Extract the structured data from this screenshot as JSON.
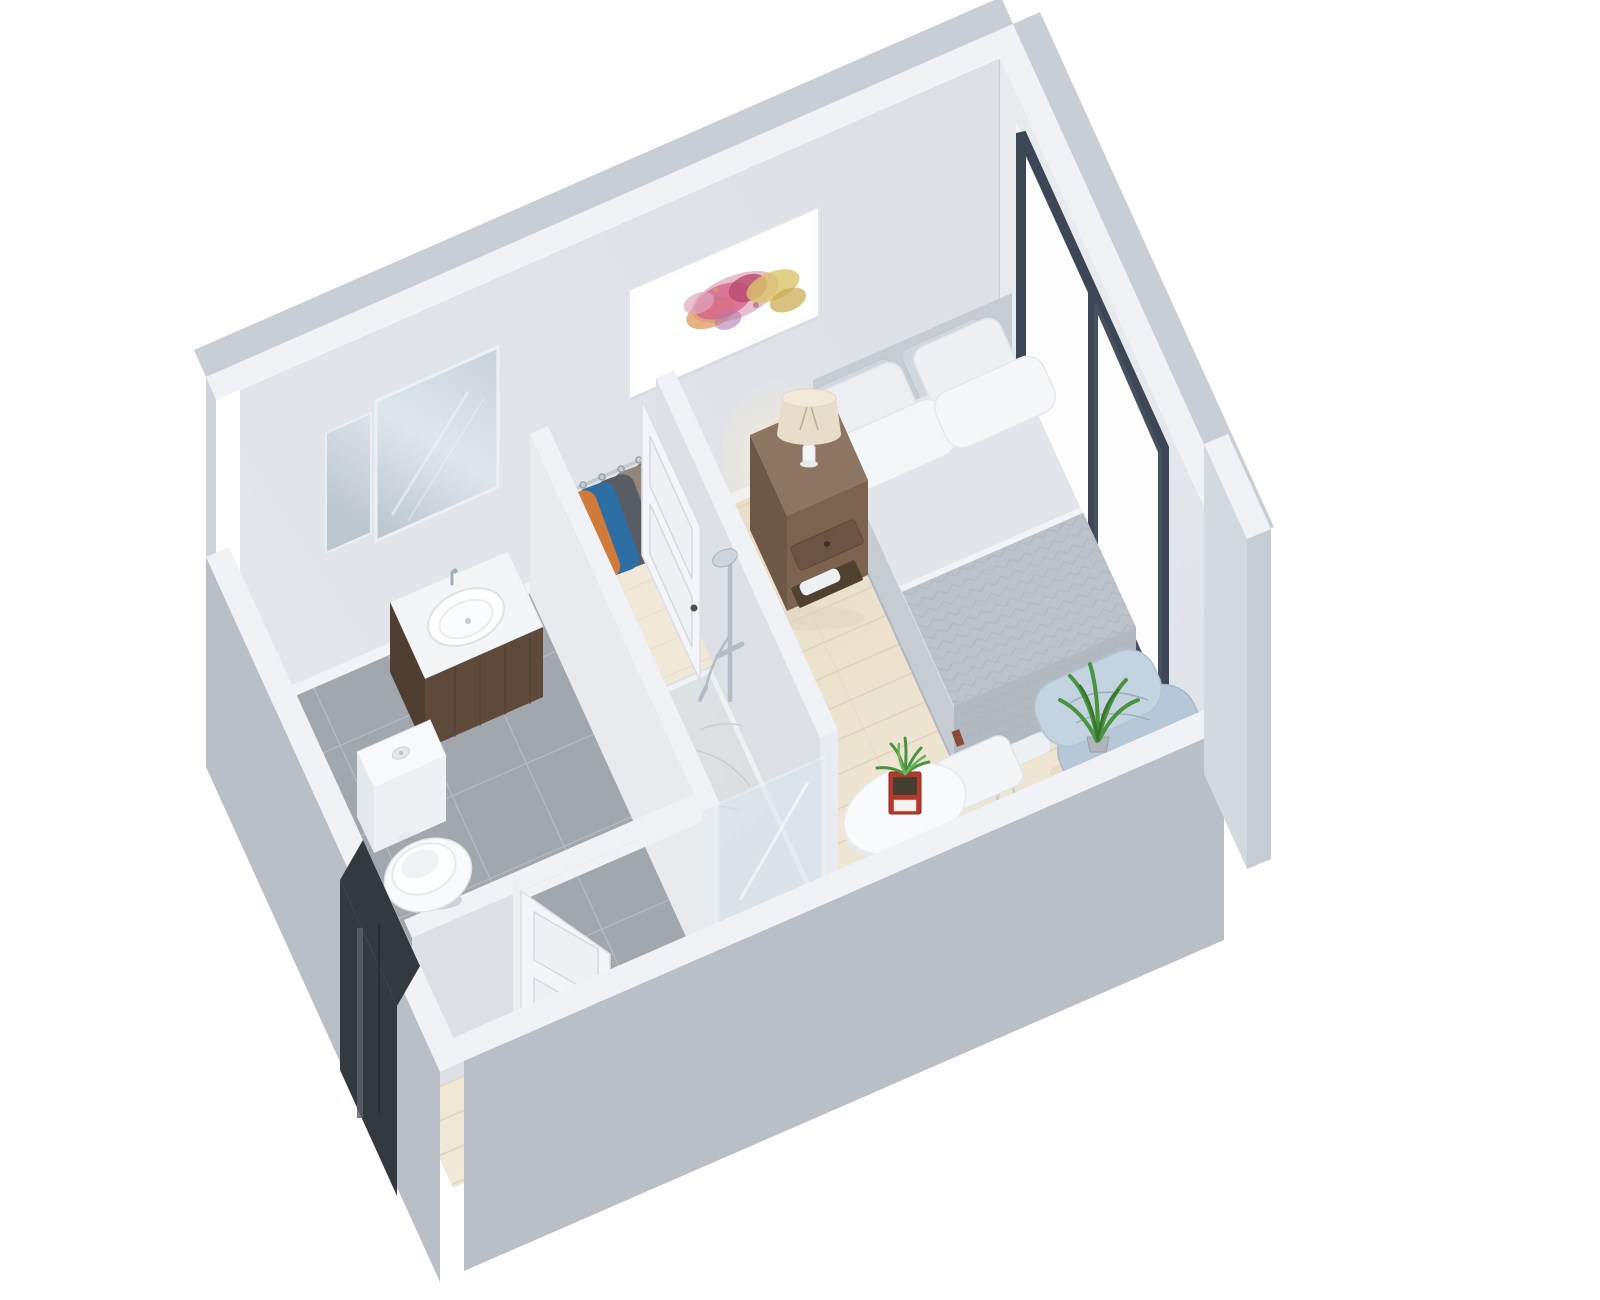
{
  "meta": {
    "title": "3D isometric floor plan render of a studio apartment with bathroom, shower, closet, bedroom and dining corner",
    "view": "dollhouse cutaway, back walls full height, front walls cut low",
    "canvas": {
      "width": 1600,
      "height": 1300
    }
  },
  "palette": {
    "background": "#ffffff",
    "wall_top": "#f0f2f6",
    "wall_exterior": "#c9ced6",
    "wall_exterior_dark": "#b9bec7",
    "wall_interior": "#dde0e5",
    "wall_interior_bright": "#e8eaee",
    "baseboard": "#f1f3f6",
    "wood_floor": "#e7dbc4",
    "wood_floor_light": "#f3ecdd",
    "plank_line": "#ddd1ba",
    "closet_floor": "#f0e9da",
    "tile_floor": "#a2a7ad",
    "tile_grout": "#b8bdc3",
    "marble_floor": "#d9dcdf",
    "marble_vein": "#c6cbd0",
    "shower_glass": "#dce9f1",
    "window_frame": "#3d4654",
    "door_white": "#f3f5f8",
    "door_panel_line": "#d5d9df",
    "door_handle": "#4a4e55",
    "entry_glass": "#34383f",
    "headboard": "#c7ccd3",
    "mattress_top": "#dadde2",
    "bed_sheet": "#e2e5e9",
    "mattress_side": "#c7ccd3",
    "mattress_foot": "#bfc5cc",
    "blanket": "#bdc2ca",
    "blanket_drape": "#b3b9c1",
    "chevron_line": "#a9afba",
    "pillow_white": "#f5f6f8",
    "nightstand_top": "#8d7563",
    "nightstand_front": "#7b634f",
    "nightstand_side": "#6d5847",
    "lamp_shade": "#e7ddca",
    "lamp_glow": "#f6ecd9",
    "art_pink_light": "#e0a7bc",
    "art_magenta": "#d4648c",
    "art_crimson": "#b84a6e",
    "art_orange": "#dd9a5e",
    "art_yellow": "#d9c469",
    "art_gold": "#c9a84c",
    "art_lilac": "#b07ab0",
    "lounge_blue_back": "#b6c8d7",
    "lounge_blue_seat": "#c4d3e0",
    "plant_green": "#4a9340",
    "plant_green_light": "#6fb35a",
    "planter_red": "#b5382d",
    "table_white": "#f8fafb",
    "chair_white": "#f3f5f7",
    "chair_leg": "#c9ced4",
    "chrome": "#b4bdc6",
    "toilet_white": "#f8fafb",
    "vanity_wood": "#5d4a3b",
    "vanity_wood_dark": "#4f3f33",
    "counter_white": "#f3f5f7",
    "jacket_colors": [
      "#d07b3c",
      "#2e6fa3",
      "#585c63",
      "#93867a",
      "#6f6961",
      "#4f5257"
    ],
    "shadow_wood": "#ddd3bf"
  },
  "scene": {
    "rooms": [
      {
        "id": "bedroom",
        "label": "Bedroom and living area, light wood floor"
      },
      {
        "id": "bathroom",
        "label": "Bathroom, gray tile floor"
      },
      {
        "id": "shower",
        "label": "Walk-in shower, marble floor, glass front"
      },
      {
        "id": "closet",
        "label": "Open closet with hanging clothes"
      },
      {
        "id": "entry",
        "label": "Entry hall with dark glass entry door"
      }
    ],
    "furniture": [
      {
        "id": "bed",
        "label": "Double bed with gray headboard, white pillows and herringbone blanket"
      },
      {
        "id": "wall-art",
        "label": "Framed abstract watercolor artwork in pink, orange and yellow"
      },
      {
        "id": "nightstand",
        "label": "Wooden nightstand with drawer, shelf and towel"
      },
      {
        "id": "table-lamp",
        "label": "Table lamp with warm glow"
      },
      {
        "id": "window",
        "label": "Large sliding window with dark frame"
      },
      {
        "id": "lounge-chair",
        "label": "Light blue butterfly lounge chair"
      },
      {
        "id": "floor-plant",
        "label": "Green floor plant"
      },
      {
        "id": "dining-table",
        "label": "Round white dining table with red planter box"
      },
      {
        "id": "dining-chair-a",
        "label": "White dining chair, upper"
      },
      {
        "id": "dining-chair-b",
        "label": "White dining chair, lower"
      },
      {
        "id": "toilet",
        "label": "White toilet"
      },
      {
        "id": "vanity",
        "label": "Dark wood vanity with white sink and mirror"
      },
      {
        "id": "shower-set",
        "label": "Chrome shower column"
      },
      {
        "id": "clothes",
        "label": "Six jackets hanging on a rail"
      },
      {
        "id": "bathroom-door",
        "label": "White paneled bathroom door, open"
      },
      {
        "id": "closet-door",
        "label": "White paneled closet door, open"
      }
    ]
  }
}
